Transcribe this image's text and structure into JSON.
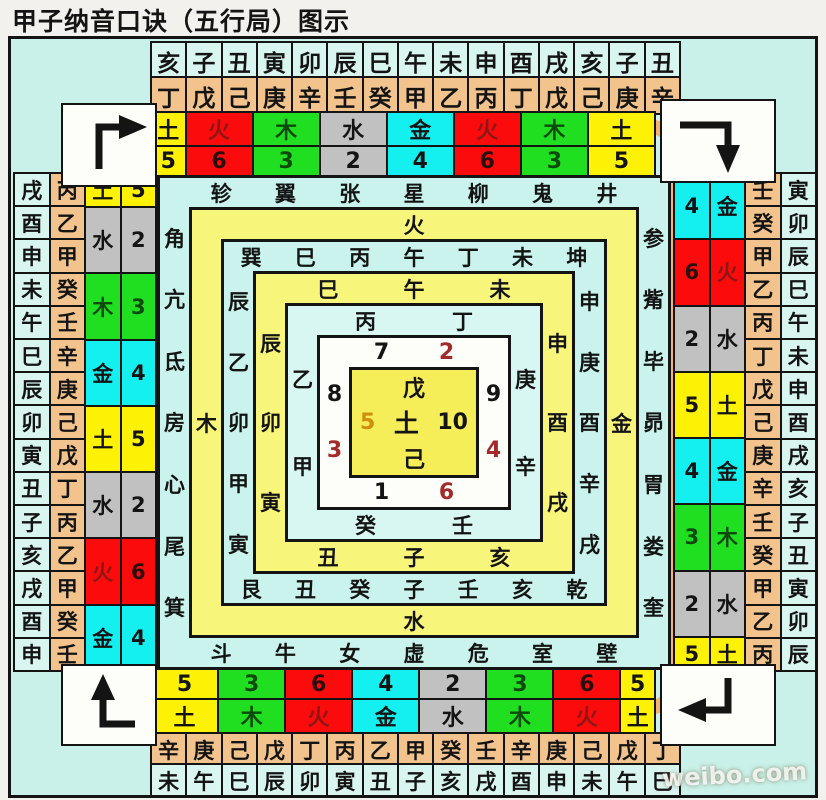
{
  "title": "甲子纳音口诀（五行局）图示",
  "watermark": "weibo.com",
  "colors": {
    "yellow": "#fdf206",
    "red": "#fb0b0b",
    "green": "#20df20",
    "gray": "#c2c1c1",
    "cyan": "#14f0f0",
    "band_orange": "#f3b26e",
    "panel_cyan": "#c9f1e9",
    "ring_yellow": "#f8f57b"
  },
  "top": {
    "branches": [
      "亥",
      "子",
      "丑",
      "寅",
      "卯",
      "辰",
      "巳",
      "午",
      "未",
      "申",
      "酉",
      "戌",
      "亥",
      "子",
      "丑"
    ],
    "stems": [
      "丁",
      "戊",
      "己",
      "庚",
      "辛",
      "壬",
      "癸",
      "甲",
      "乙",
      "丙",
      "丁",
      "戊",
      "己",
      "庚",
      "辛"
    ],
    "elements": [
      {
        "element": "土",
        "number": "5",
        "color": "yellow",
        "narrow": true
      },
      {
        "element": "火",
        "number": "6",
        "color": "red"
      },
      {
        "element": "木",
        "number": "3",
        "color": "green"
      },
      {
        "element": "水",
        "number": "2",
        "color": "gray"
      },
      {
        "element": "金",
        "number": "4",
        "color": "cyan"
      },
      {
        "element": "火",
        "number": "6",
        "color": "red"
      },
      {
        "element": "木",
        "number": "3",
        "color": "green"
      },
      {
        "element": "土",
        "number": "5",
        "color": "yellow"
      }
    ]
  },
  "bottom": {
    "elements": [
      {
        "element": "土",
        "number": "5",
        "color": "yellow"
      },
      {
        "element": "木",
        "number": "3",
        "color": "green"
      },
      {
        "element": "火",
        "number": "6",
        "color": "red"
      },
      {
        "element": "金",
        "number": "4",
        "color": "cyan"
      },
      {
        "element": "水",
        "number": "2",
        "color": "gray"
      },
      {
        "element": "木",
        "number": "3",
        "color": "green"
      },
      {
        "element": "火",
        "number": "6",
        "color": "red"
      },
      {
        "element": "土",
        "number": "5",
        "color": "yellow",
        "narrow": true
      }
    ],
    "stems": [
      "辛",
      "庚",
      "己",
      "戊",
      "丁",
      "丙",
      "乙",
      "甲",
      "癸",
      "壬",
      "辛",
      "庚",
      "己",
      "戊",
      "丁"
    ],
    "branches": [
      "未",
      "午",
      "巳",
      "辰",
      "卯",
      "寅",
      "丑",
      "子",
      "亥",
      "戌",
      "酉",
      "申",
      "未",
      "午",
      "巳"
    ]
  },
  "left": {
    "branches": [
      "戌",
      "酉",
      "申",
      "未",
      "午",
      "巳",
      "辰",
      "卯",
      "寅",
      "丑",
      "子",
      "亥",
      "戌",
      "酉",
      "申"
    ],
    "stems": [
      "丙",
      "乙",
      "甲",
      "癸",
      "壬",
      "辛",
      "庚",
      "己",
      "戊",
      "丁",
      "丙",
      "乙",
      "甲",
      "癸",
      "壬"
    ],
    "groups": [
      {
        "element": "土",
        "number": "5",
        "color": "yellow",
        "span": 1
      },
      {
        "element": "水",
        "number": "2",
        "color": "gray",
        "span": 2
      },
      {
        "element": "木",
        "number": "3",
        "color": "green",
        "span": 2
      },
      {
        "element": "金",
        "number": "4",
        "color": "cyan",
        "span": 2
      },
      {
        "element": "土",
        "number": "5",
        "color": "yellow",
        "span": 2
      },
      {
        "element": "水",
        "number": "2",
        "color": "gray",
        "span": 2
      },
      {
        "element": "火",
        "number": "6",
        "color": "red",
        "span": 2
      },
      {
        "element": "金",
        "number": "4",
        "color": "cyan",
        "span": 2
      }
    ]
  },
  "right": {
    "stems": [
      "壬",
      "癸",
      "甲",
      "乙",
      "丙",
      "丁",
      "戊",
      "己",
      "庚",
      "辛",
      "壬",
      "癸",
      "甲",
      "乙",
      "丙"
    ],
    "branches": [
      "寅",
      "卯",
      "辰",
      "巳",
      "午",
      "未",
      "申",
      "酉",
      "戌",
      "亥",
      "子",
      "丑",
      "寅",
      "卯",
      "辰"
    ],
    "groups": [
      {
        "element": "金",
        "number": "4",
        "color": "cyan",
        "span": 2
      },
      {
        "element": "火",
        "number": "6",
        "color": "red",
        "span": 2
      },
      {
        "element": "水",
        "number": "2",
        "color": "gray",
        "span": 2
      },
      {
        "element": "土",
        "number": "5",
        "color": "yellow",
        "span": 2
      },
      {
        "element": "金",
        "number": "4",
        "color": "cyan",
        "span": 2
      },
      {
        "element": "木",
        "number": "3",
        "color": "green",
        "span": 2
      },
      {
        "element": "水",
        "number": "2",
        "color": "gray",
        "span": 2
      },
      {
        "element": "土",
        "number": "5",
        "color": "yellow",
        "span": 1
      }
    ]
  },
  "center": {
    "mansions": {
      "top": [
        "轸",
        "翼",
        "张",
        "星",
        "柳",
        "鬼",
        "井"
      ],
      "right": [
        "参",
        "觜",
        "毕",
        "昴",
        "胃",
        "娄",
        "奎"
      ],
      "bottom": [
        "斗",
        "牛",
        "女",
        "虚",
        "危",
        "室",
        "壁"
      ],
      "left": [
        "角",
        "亢",
        "氐",
        "房",
        "心",
        "尾",
        "箕"
      ]
    },
    "ring2": {
      "top": "火",
      "right": "金",
      "bottom": "水",
      "left": "木"
    },
    "ring3": {
      "top": [
        "巽",
        "巳",
        "丙",
        "午",
        "丁",
        "未",
        "坤"
      ],
      "right": [
        "申",
        "庚",
        "酉",
        "辛",
        "戌"
      ],
      "bottom": [
        "艮",
        "丑",
        "癸",
        "子",
        "壬",
        "亥",
        "乾"
      ],
      "left": [
        "辰",
        "乙",
        "卯",
        "甲",
        "寅"
      ]
    },
    "ring4": {
      "top": [
        "巳",
        "午",
        "未"
      ],
      "right": [
        "申",
        "酉",
        "戌"
      ],
      "bottom": [
        "丑",
        "子",
        "亥"
      ],
      "left": [
        "辰",
        "卯",
        "寅"
      ]
    },
    "ring5": {
      "top": [
        "丙",
        "丁"
      ],
      "right": [
        "庚",
        "辛"
      ],
      "bottom": [
        "癸",
        "壬"
      ],
      "left": [
        "乙",
        "甲"
      ]
    },
    "ring6": {
      "top": [
        {
          "n": "7"
        },
        {
          "n": "2",
          "red": true
        }
      ],
      "right": [
        {
          "n": "9"
        },
        {
          "n": "4",
          "red": true
        }
      ],
      "bottom": [
        {
          "n": "1"
        },
        {
          "n": "6",
          "red": true
        }
      ],
      "left": [
        {
          "n": "8"
        },
        {
          "n": "3",
          "red": true
        }
      ]
    },
    "core": {
      "top": "戊",
      "left": "5",
      "center": "土",
      "right": "10",
      "bottom": "己"
    }
  }
}
